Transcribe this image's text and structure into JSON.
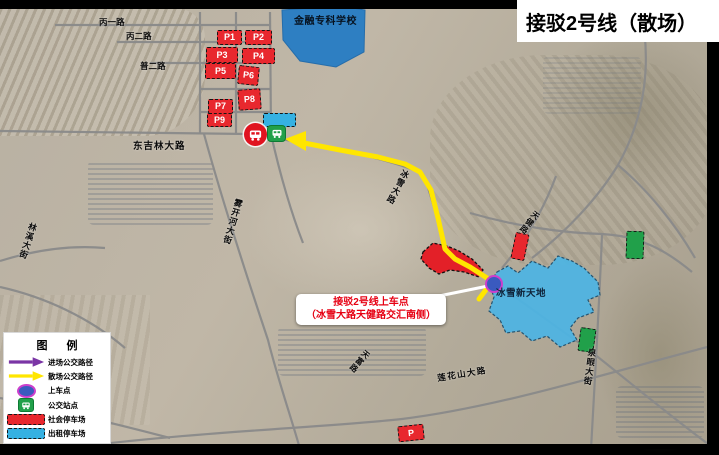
{
  "title": "接驳2号线（散场）",
  "legend": {
    "title": "图 例",
    "items": [
      {
        "label": "进场公交路径",
        "icon": "purple-arrow",
        "color": "#7a35a5"
      },
      {
        "label": "散场公交路径",
        "icon": "yellow-arrow",
        "color": "#ffe600"
      },
      {
        "label": "上车点",
        "icon": "boarding-point-ellipse",
        "color": "#3a5abf"
      },
      {
        "label": "公交站点",
        "icon": "bus-station",
        "color": "#21a04a"
      },
      {
        "label": "社会停车场",
        "icon": "red-dashed-rect",
        "color": "#e8282e"
      },
      {
        "label": "出租停车场",
        "icon": "cyan-dashed-rect",
        "color": "#35b1e2"
      }
    ]
  },
  "map": {
    "school_label": "金融专科学校",
    "venue_label": "冰雪新天地",
    "callout": {
      "line1": "接驳2号线上车点",
      "line2": "（冰雪大路天健路交汇南侧）"
    },
    "parking_lots": [
      "P1",
      "P2",
      "P3",
      "P4",
      "P5",
      "P6",
      "P7",
      "P8",
      "P9"
    ],
    "extra_parking_label": "P",
    "road_labels": [
      "丙一路",
      "丙二路",
      "普二路",
      "东吉林大路",
      "林溪大街",
      "雾开河大街",
      "冰雪大路",
      "天健路",
      "天富路",
      "泉眼大街",
      "莲花山大路"
    ]
  },
  "colors": {
    "social_parking": "#e8282e",
    "taxi_parking": "#35b1e2",
    "shuttle_route": "#ffe600",
    "inbound_route": "#7a35a5",
    "boarding_point": "#3a5abf",
    "boarding_ring": "#cc3fcc",
    "school_area": "#2e7fc2",
    "venue_area": "#4cb4e4",
    "bus_stop_red": "#e0131f",
    "bus_stop_green": "#21a04a"
  }
}
